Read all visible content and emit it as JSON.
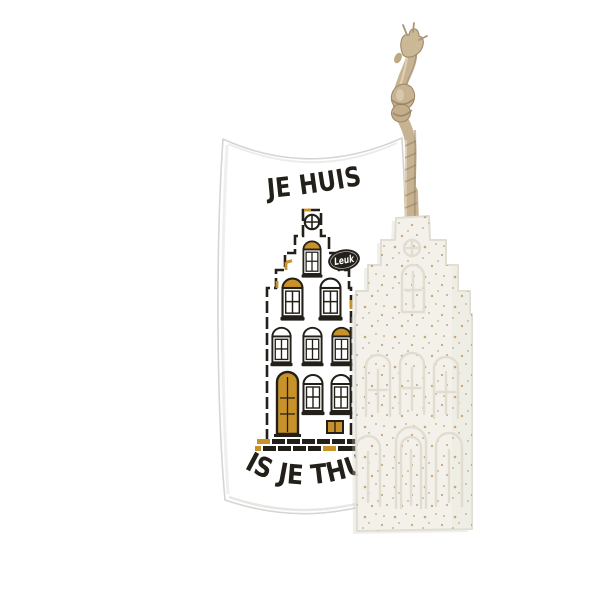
{
  "product_scene": {
    "background_color": "#ffffff",
    "package": {
      "kind": "pillow-box",
      "face_color": "#ffffff",
      "edge_color": "#d6d5d2",
      "top_text": "JE HUIS",
      "bottom_text": "IS JE THUIS",
      "text_color": "#232019",
      "badge": {
        "label": "Leuk",
        "bg_color": "#232019",
        "text_color": "#ffffff"
      },
      "illustration": {
        "kind": "dutch-canal-house",
        "ink_color": "#232019",
        "gold_color": "#c8922a",
        "window_color": "#ffffff"
      }
    },
    "soap": {
      "kind": "house-shaped-soap",
      "body_color": "#f3f1ea",
      "edge_color": "#e0ddd2",
      "emboss_color": "#e1ddd0",
      "speckle_colors": [
        "#c29a63",
        "#a89a86",
        "#8a7a5f"
      ]
    },
    "rope": {
      "kind": "jute-hanging-cord",
      "color": "#c7b394",
      "shadow_color": "#9b8662",
      "highlight_color": "#e3d6ba"
    }
  }
}
